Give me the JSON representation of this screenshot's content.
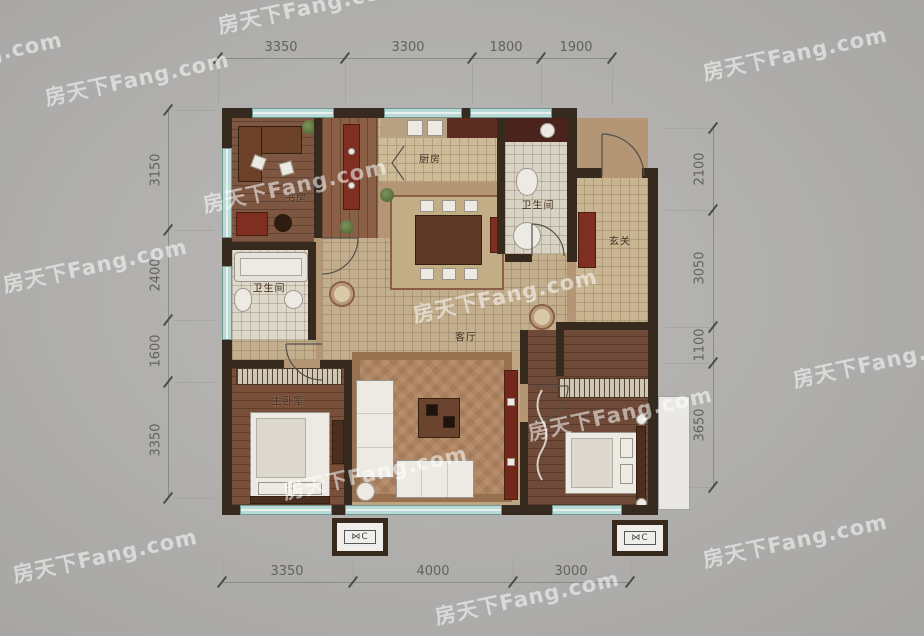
{
  "watermark": {
    "text": "房天下Fang.com",
    "color": "rgba(255,255,255,0.55)"
  },
  "dimensions": {
    "top": [
      "3350",
      "3300",
      "1800",
      "1900"
    ],
    "bottom": [
      "3350",
      "4000",
      "3000"
    ],
    "left": [
      "3150",
      "2400",
      "1600",
      "3350"
    ],
    "right": [
      "2100",
      "3050",
      "1100",
      "3650"
    ]
  },
  "rooms": {
    "study": "书房",
    "kitchen": "厨房",
    "bath_top": "卫生间",
    "entry": "玄关",
    "bath_left": "卫生间",
    "living": "客厅",
    "storage": "储藏",
    "master": "主卧室"
  },
  "ac": {
    "symbol": "⋈C"
  },
  "colors": {
    "background": "#adacaa",
    "wall": "#36291f",
    "window_glass": "#b9dad5",
    "floor_wood": "#7d5742",
    "tile": "#cdbb97",
    "accent_red": "#7e2f22",
    "dimension_text": "#62615f",
    "watermark": "rgba(255,255,255,0.55)"
  }
}
